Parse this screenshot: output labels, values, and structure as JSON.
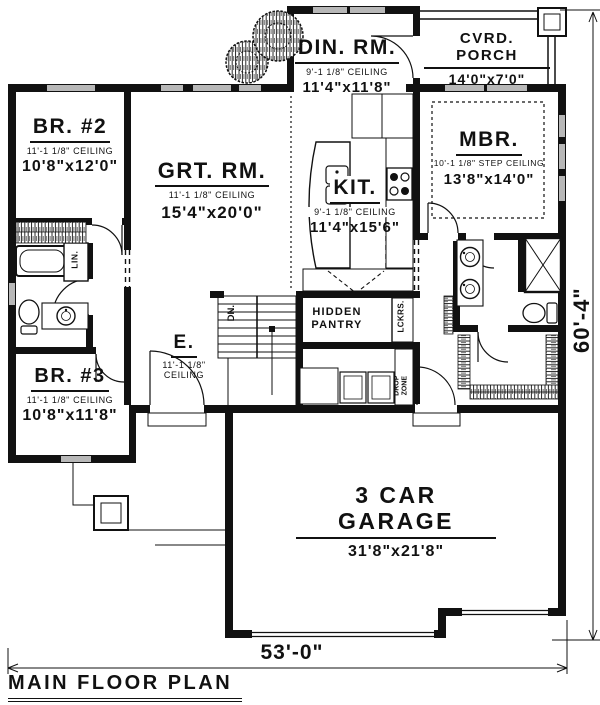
{
  "title": {
    "text": "MAIN FLOOR PLAN"
  },
  "dimensions": {
    "overall_width": "53'-0\"",
    "overall_height": "60'-4\""
  },
  "rooms": {
    "br2": {
      "name": "BR. #2",
      "ceiling": "11'-1 1/8\" CEILING",
      "size": "10'8\"x12'0\""
    },
    "grt_rm": {
      "name": "GRT. RM.",
      "ceiling": "11'-1 1/8\" CEILING",
      "size": "15'4\"x20'0\""
    },
    "din_rm": {
      "name": "DIN. RM.",
      "ceiling": "9'-1 1/8\" CEILING",
      "size": "11'4\"x11'8\""
    },
    "cvrd_porch": {
      "name": "CVRD. PORCH",
      "size": "14'0\"x7'0\""
    },
    "mbr": {
      "name": "MBR.",
      "ceiling": "10'-1 1/8\" STEP CEILING",
      "size": "13'8\"x14'0\""
    },
    "kit": {
      "name": "KIT.",
      "ceiling": "9'-1 1/8\" CEILING",
      "size": "11'4\"x15'6\""
    },
    "br3": {
      "name": "BR. #3",
      "ceiling": "11'-1 1/8\" CEILING",
      "size": "10'8\"x11'8\""
    },
    "entry": {
      "name": "E.",
      "ceiling_l1": "11'-1 1/8\"",
      "ceiling_l2": "CEILING"
    },
    "hidden_pantry": {
      "l1": "HIDDEN",
      "l2": "PANTRY"
    },
    "garage": {
      "name": "3 CAR GARAGE",
      "size": "31'8\"x21'8\""
    }
  },
  "annotations": {
    "lin": "LIN.",
    "dn": "DN.",
    "lckrs": "LCKRS.",
    "drop_l1": "DROP",
    "drop_l2": "ZONE"
  },
  "colors": {
    "ink": "#111111",
    "window": "#b8b8b8",
    "paper": "#ffffff"
  }
}
